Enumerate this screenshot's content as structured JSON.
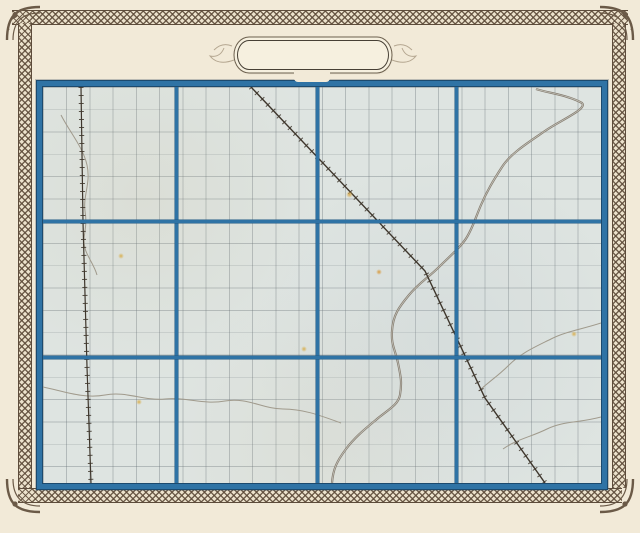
{
  "title": {
    "prefix": "MAP OF",
    "name": "PULASKI",
    "suffix": "COUNTY.",
    "year": "1876"
  },
  "frame": {
    "top": {
      "county": "STARKE",
      "co": "CO."
    },
    "left": {
      "county": "JASPER",
      "co": "CO."
    },
    "right": {
      "county": "FULTON",
      "co": "CO.",
      "township_rows": [
        "Town. XXXI North.",
        "Town. XXX North.",
        "Town. XXIX North."
      ]
    },
    "bottom": {
      "county_white": "WHITE",
      "co_white": "CO.",
      "county_cass": "CASS CO.",
      "ranges": [
        "Range IV West.",
        "Range III West.",
        "Range II West.",
        "Range I West."
      ]
    }
  },
  "townships": [
    {
      "name": "CASS",
      "col": 0,
      "row": 0
    },
    {
      "name": "RICH GROVE",
      "col": 1,
      "row": 0
    },
    {
      "name": "FRANKLIN",
      "col": 2,
      "row": 0
    },
    {
      "name": "TIPPECANOE",
      "col": 3,
      "row": 0
    },
    {
      "name": "WHITE POST",
      "col": 0,
      "row": 1
    },
    {
      "name": "JEFFERSON",
      "col": 1,
      "row": 1
    },
    {
      "name": "MONROE",
      "col": 2,
      "row": 1
    },
    {
      "name": "HARRISON",
      "col": 3,
      "row": 1
    },
    {
      "name": "SALEM",
      "col": 0,
      "row": 2
    },
    {
      "name": "BEAVER",
      "col": 1,
      "row": 2
    },
    {
      "name": "INDIAN CREEK",
      "col": 2,
      "row": 2
    },
    {
      "name": "VAN BUREN",
      "col": 3,
      "row": 2
    }
  ],
  "towns": [
    {
      "name": "MONTEREY",
      "x": 538,
      "y": 14,
      "w": 8,
      "h": 6,
      "lx": 494,
      "ly": 9
    },
    {
      "name": "MEDARYVILLE",
      "x": 40,
      "y": 135,
      "w": 7,
      "h": 7,
      "lx": 2,
      "ly": 128
    },
    {
      "name": "WINAMAC",
      "x": 382,
      "y": 182,
      "w": 13,
      "h": 10,
      "lx": 346,
      "ly": 175
    },
    {
      "name": "FRANCESVILLE",
      "x": 44,
      "y": 280,
      "w": 7,
      "h": 6,
      "lx": 30,
      "ly": 289
    },
    {
      "name": "PULASKI",
      "x": 356,
      "y": 308,
      "w": 7,
      "h": 6,
      "lx": 318,
      "ly": 306
    },
    {
      "name": "STAR\nCITY",
      "x": 442,
      "y": 311,
      "w": 7,
      "h": 7,
      "lx": 451,
      "ly": 303
    },
    {
      "name": "KENDALL",
      "x": 477,
      "y": 382,
      "w": 6,
      "h": 7,
      "lx": 448,
      "ly": 385
    }
  ],
  "railroads": [
    {
      "label": "PITTSBURGH CIN. & ST. LOUIS R.W."
    }
  ],
  "grid": {
    "columns": 4,
    "rows": 3,
    "sections_per_township": "1-36"
  },
  "colors": {
    "paper": "#f2ead8",
    "map_paper": "#dee4e1",
    "blue": "#2f73a5",
    "blue_dark": "#1c4a6e",
    "lattice_brown": "#5d4c3b",
    "ink": "#35302a",
    "river": "#867d70",
    "town_navy": "#1d2b4e"
  }
}
